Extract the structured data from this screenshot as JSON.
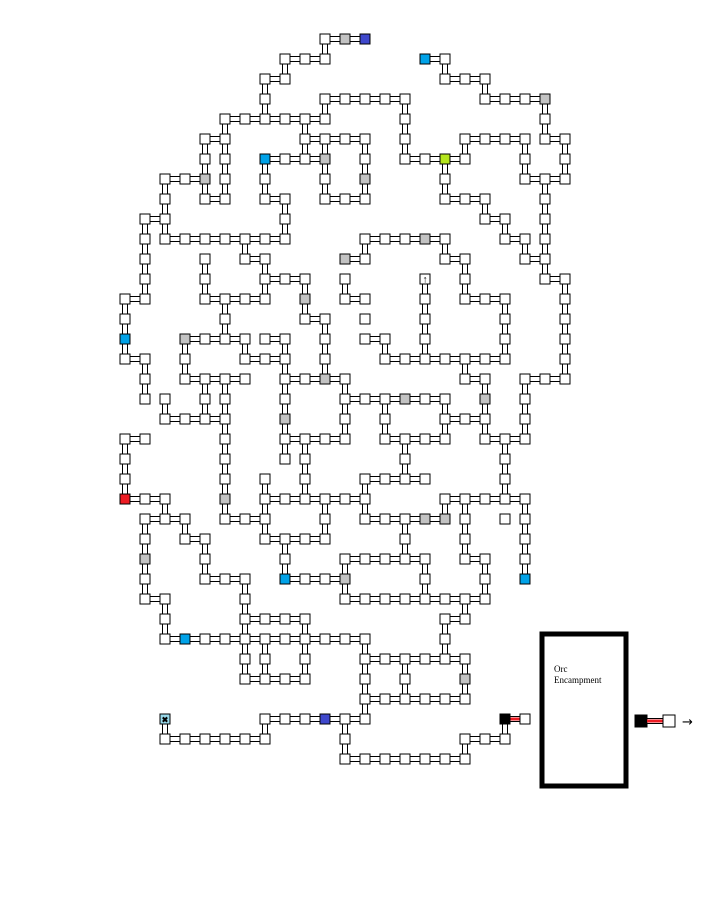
{
  "canvas": {
    "width": 706,
    "height": 902,
    "background": "#ffffff"
  },
  "orc_box": {
    "lines": [
      "Orc",
      "Encampment"
    ]
  },
  "legend": {
    "arrow": "→"
  },
  "map": {
    "grid": {
      "x0": 125,
      "y0": 39,
      "pitch": 20,
      "room_size": 10
    },
    "colors": {
      "w": "#ffffff",
      "g": "#c3c3c3",
      "c": "#00a2e8",
      "b": "#3f48cc",
      "r": "#ed1c24",
      "n": "#b5e61d",
      "k": "#000000",
      "x": "#99d9ea",
      "u": "#ffffff"
    },
    "glyphs": {
      "u": "↑",
      "x": "✖"
    },
    "rooms": [
      "10,0,w",
      "11,0,g",
      "12,0,b",
      "8,1,w",
      "9,1,w",
      "10,1,w",
      "15,1,c",
      "16,1,w",
      "7,2,w",
      "8,2,w",
      "16,2,w",
      "17,2,w",
      "18,2,w",
      "7,3,w",
      "10,3,w",
      "11,3,w",
      "12,3,w",
      "13,3,w",
      "14,3,w",
      "18,3,w",
      "19,3,w",
      "20,3,w",
      "21,3,g",
      "5,4,w",
      "6,4,w",
      "7,4,w",
      "8,4,w",
      "9,4,w",
      "10,4,w",
      "14,4,w",
      "21,4,w",
      "4,5,w",
      "5,5,w",
      "9,5,w",
      "10,5,w",
      "11,5,w",
      "12,5,w",
      "14,5,w",
      "17,5,w",
      "18,5,w",
      "19,5,w",
      "20,5,w",
      "21,5,w",
      "22,5,w",
      "4,6,w",
      "5,6,w",
      "7,6,c",
      "8,6,w",
      "9,6,w",
      "10,6,g",
      "12,6,w",
      "14,6,w",
      "15,6,w",
      "16,6,n",
      "17,6,w",
      "20,6,w",
      "22,6,w",
      "2,7,w",
      "3,7,w",
      "4,7,g",
      "5,7,w",
      "7,7,w",
      "10,7,w",
      "12,7,g",
      "16,7,w",
      "20,7,w",
      "21,7,w",
      "22,7,w",
      "2,8,w",
      "4,8,w",
      "5,8,w",
      "7,8,w",
      "8,8,w",
      "10,8,w",
      "11,8,w",
      "12,8,w",
      "16,8,w",
      "17,8,w",
      "18,8,w",
      "21,8,w",
      "1,9,w",
      "2,9,w",
      "8,9,w",
      "18,9,w",
      "19,9,w",
      "21,9,w",
      "1,10,w",
      "2,10,w",
      "3,10,w",
      "4,10,w",
      "5,10,w",
      "6,10,w",
      "7,10,w",
      "8,10,w",
      "12,10,w",
      "13,10,w",
      "14,10,w",
      "15,10,g",
      "16,10,w",
      "19,10,w",
      "20,10,w",
      "21,10,w",
      "1,11,w",
      "4,11,w",
      "6,11,w",
      "7,11,w",
      "11,11,g",
      "12,11,w",
      "16,11,w",
      "17,11,w",
      "20,11,w",
      "21,11,w",
      "1,12,w",
      "4,12,w",
      "7,12,w",
      "8,12,w",
      "9,12,w",
      "11,12,w",
      "15,12,u",
      "17,12,w",
      "21,12,w",
      "22,12,w",
      "0,13,w",
      "1,13,w",
      "4,13,w",
      "5,13,w",
      "6,13,w",
      "7,13,w",
      "9,13,g",
      "11,13,w",
      "12,13,w",
      "15,13,w",
      "17,13,w",
      "18,13,w",
      "19,13,w",
      "22,13,w",
      "0,14,w",
      "5,14,w",
      "9,14,w",
      "10,14,w",
      "12,14,w",
      "15,14,w",
      "19,14,w",
      "22,14,w",
      "0,15,c",
      "3,15,g",
      "4,15,w",
      "5,15,w",
      "6,15,w",
      "7,15,w",
      "8,15,w",
      "10,15,w",
      "12,15,w",
      "13,15,w",
      "15,15,w",
      "19,15,w",
      "22,15,w",
      "0,16,w",
      "1,16,w",
      "3,16,w",
      "6,16,w",
      "7,16,w",
      "8,16,w",
      "10,16,w",
      "13,16,w",
      "14,16,w",
      "15,16,w",
      "16,16,w",
      "17,16,w",
      "18,16,w",
      "19,16,w",
      "22,16,w",
      "1,17,w",
      "3,17,w",
      "4,17,w",
      "5,17,w",
      "6,17,w",
      "8,17,w",
      "9,17,w",
      "10,17,g",
      "11,17,w",
      "17,17,w",
      "18,17,w",
      "20,17,w",
      "21,17,w",
      "22,17,w",
      "1,18,w",
      "2,18,w",
      "4,18,w",
      "5,18,w",
      "8,18,w",
      "11,18,w",
      "12,18,w",
      "13,18,w",
      "14,18,g",
      "15,18,w",
      "16,18,w",
      "18,18,g",
      "20,18,w",
      "2,19,w",
      "3,19,w",
      "4,19,w",
      "5,19,w",
      "8,19,g",
      "11,19,w",
      "13,19,w",
      "16,19,w",
      "17,19,w",
      "18,19,w",
      "20,19,w",
      "0,20,w",
      "1,20,w",
      "5,20,w",
      "8,20,w",
      "9,20,w",
      "10,20,w",
      "11,20,w",
      "13,20,w",
      "14,20,w",
      "15,20,w",
      "16,20,w",
      "18,20,w",
      "19,20,w",
      "20,20,w",
      "0,21,w",
      "5,21,w",
      "8,21,w",
      "9,21,w",
      "14,21,w",
      "19,21,w",
      "0,22,w",
      "5,22,w",
      "7,22,w",
      "9,22,w",
      "12,22,w",
      "13,22,w",
      "14,22,w",
      "15,22,w",
      "19,22,w",
      "0,23,r",
      "1,23,w",
      "2,23,w",
      "5,23,g",
      "7,23,w",
      "8,23,w",
      "9,23,w",
      "10,23,w",
      "11,23,w",
      "12,23,w",
      "16,23,w",
      "17,23,w",
      "18,23,w",
      "19,23,w",
      "20,23,w",
      "1,24,w",
      "2,24,w",
      "3,24,w",
      "5,24,w",
      "6,24,w",
      "7,24,w",
      "10,24,w",
      "12,24,w",
      "13,24,w",
      "14,24,w",
      "15,24,g",
      "16,24,g",
      "17,24,w",
      "19,24,w",
      "20,24,w",
      "1,25,w",
      "3,25,w",
      "4,25,w",
      "7,25,w",
      "8,25,w",
      "9,25,w",
      "10,25,w",
      "14,25,w",
      "17,25,w",
      "20,25,w",
      "1,26,g",
      "4,26,w",
      "8,26,w",
      "11,26,w",
      "12,26,w",
      "13,26,w",
      "14,26,w",
      "15,26,w",
      "17,26,w",
      "18,26,w",
      "20,26,w",
      "1,27,w",
      "4,27,w",
      "5,27,w",
      "6,27,w",
      "8,27,c",
      "9,27,w",
      "10,27,w",
      "11,27,g",
      "15,27,w",
      "18,27,w",
      "20,27,c",
      "1,28,w",
      "2,28,w",
      "6,28,w",
      "11,28,w",
      "12,28,w",
      "13,28,w",
      "14,28,w",
      "15,28,w",
      "16,28,w",
      "17,28,w",
      "18,28,w",
      "2,29,w",
      "6,29,w",
      "7,29,w",
      "8,29,w",
      "9,29,w",
      "16,29,w",
      "17,29,w",
      "2,30,w",
      "3,30,c",
      "4,30,w",
      "5,30,w",
      "6,30,w",
      "7,30,w",
      "8,30,w",
      "9,30,w",
      "10,30,w",
      "11,30,w",
      "12,30,w",
      "16,30,w",
      "6,31,w",
      "7,31,w",
      "9,31,w",
      "12,31,w",
      "13,31,w",
      "14,31,w",
      "15,31,w",
      "16,31,w",
      "17,31,w",
      "6,32,w",
      "7,32,w",
      "8,32,w",
      "9,32,w",
      "12,32,w",
      "14,32,w",
      "17,32,g",
      "12,33,w",
      "13,33,w",
      "14,33,w",
      "15,33,w",
      "16,33,w",
      "17,33,w",
      "2,34,x",
      "7,34,w",
      "8,34,w",
      "9,34,w",
      "10,34,b",
      "11,34,w",
      "12,34,w",
      "19,34,k",
      "20,34,w",
      "2,35,w",
      "3,35,w",
      "4,35,w",
      "5,35,w",
      "6,35,w",
      "7,35,w",
      "11,35,w",
      "17,35,w",
      "18,35,w",
      "19,35,w",
      "11,36,w",
      "12,36,w",
      "13,36,w",
      "14,36,w",
      "15,36,w",
      "16,36,w",
      "17,36,w"
    ],
    "edges": [
      "10,0|11,0",
      "11,0|12,0",
      "8,1|9,1",
      "9,1|10,1",
      "15,1|16,1",
      "7,2|8,2",
      "16,2|17,2",
      "17,2|18,2",
      "10,3|11,3",
      "11,3|12,3",
      "12,3|13,3",
      "13,3|14,3",
      "18,3|19,3",
      "19,3|20,3",
      "20,3|21,3",
      "5,4|6,4",
      "6,4|7,4",
      "7,4|8,4",
      "8,4|9,4",
      "9,4|10,4",
      "4,5|5,5",
      "9,5|10,5",
      "10,5|11,5",
      "11,5|12,5",
      "17,5|18,5",
      "18,5|19,5",
      "19,5|20,5",
      "21,5|22,5",
      "7,6|8,6",
      "8,6|9,6",
      "9,6|10,6",
      "14,6|15,6",
      "15,6|16,6",
      "16,6|17,6",
      "2,7|3,7",
      "3,7|4,7",
      "20,7|21,7",
      "21,7|22,7",
      "4,8|5,8",
      "7,8|8,8",
      "10,8|11,8",
      "11,8|12,8",
      "16,8|17,8",
      "17,8|18,8",
      "1,9|2,9",
      "18,9|19,9",
      "2,10|3,10",
      "3,10|4,10",
      "4,10|5,10",
      "5,10|6,10",
      "6,10|7,10",
      "7,10|8,10",
      "12,10|13,10",
      "13,10|14,10",
      "14,10|15,10",
      "15,10|16,10",
      "19,10|20,10",
      "6,11|7,11",
      "11,11|12,11",
      "16,11|17,11",
      "20,11|21,11",
      "7,12|8,12",
      "8,12|9,12",
      "21,12|22,12",
      "0,13|1,13",
      "4,13|5,13",
      "5,13|6,13",
      "6,13|7,13",
      "11,13|12,13",
      "17,13|18,13",
      "18,13|19,13",
      "9,14|10,14",
      "3,15|4,15",
      "4,15|5,15",
      "5,15|6,15",
      "7,15|8,15",
      "12,15|13,15",
      "0,16|1,16",
      "6,16|7,16",
      "7,16|8,16",
      "13,16|14,16",
      "14,16|15,16",
      "15,16|16,16",
      "16,16|17,16",
      "17,16|18,16",
      "18,16|19,16",
      "3,17|4,17",
      "4,17|5,17",
      "5,17|6,17",
      "8,17|9,17",
      "9,17|10,17",
      "10,17|11,17",
      "17,17|18,17",
      "20,17|21,17",
      "21,17|22,17",
      "11,18|12,18",
      "12,18|13,18",
      "13,18|14,18",
      "14,18|15,18",
      "15,18|16,18",
      "2,19|3,19",
      "3,19|4,19",
      "4,19|5,19",
      "16,19|17,19",
      "17,19|18,19",
      "0,20|1,20",
      "8,20|9,20",
      "9,20|10,20",
      "10,20|11,20",
      "13,20|14,20",
      "14,20|15,20",
      "15,20|16,20",
      "18,20|19,20",
      "19,20|20,20",
      "12,22|13,22",
      "13,22|14,22",
      "14,22|15,22",
      "0,23|1,23",
      "1,23|2,23",
      "7,23|8,23",
      "8,23|9,23",
      "9,23|10,23",
      "10,23|11,23",
      "11,23|12,23",
      "16,23|17,23",
      "17,23|18,23",
      "18,23|19,23",
      "19,23|20,23",
      "1,24|2,24",
      "2,24|3,24",
      "5,24|6,24",
      "6,24|7,24",
      "12,24|13,24",
      "13,24|14,24",
      "14,24|15,24",
      "15,24|16,24",
      "3,25|4,25",
      "7,25|8,25",
      "8,25|9,25",
      "9,25|10,25",
      "11,26|12,26",
      "12,26|13,26",
      "13,26|14,26",
      "14,26|15,26",
      "17,26|18,26",
      "4,27|5,27",
      "5,27|6,27",
      "8,27|9,27",
      "9,27|10,27",
      "10,27|11,27",
      "1,28|2,28",
      "11,28|12,28",
      "12,28|13,28",
      "13,28|14,28",
      "14,28|15,28",
      "15,28|16,28",
      "16,28|17,28",
      "17,28|18,28",
      "6,29|7,29",
      "7,29|8,29",
      "8,29|9,29",
      "16,29|17,29",
      "2,30|3,30",
      "3,30|4,30",
      "4,30|5,30",
      "5,30|6,30",
      "6,30|7,30",
      "7,30|8,30",
      "8,30|9,30",
      "9,30|10,30",
      "10,30|11,30",
      "11,30|12,30",
      "12,31|13,31",
      "13,31|14,31",
      "14,31|15,31",
      "15,31|16,31",
      "16,31|17,31",
      "6,32|7,32",
      "7,32|8,32",
      "8,32|9,32",
      "12,33|13,33",
      "13,33|14,33",
      "14,33|15,33",
      "15,33|16,33",
      "16,33|17,33",
      "7,34|8,34",
      "8,34|9,34",
      "9,34|10,34",
      "10,34|11,34",
      "11,34|12,34",
      "2,35|3,35",
      "3,35|4,35",
      "4,35|5,35",
      "5,35|6,35",
      "6,35|7,35",
      "17,35|18,35",
      "18,35|19,35",
      "11,36|12,36",
      "12,36|13,36",
      "13,36|14,36",
      "14,36|15,36",
      "15,36|16,36",
      "16,36|17,36",
      "0,13|0,14",
      "0,14|0,15",
      "0,15|0,16",
      "0,20|0,21",
      "0,21|0,22",
      "0,22|0,23",
      "1,9|1,10",
      "1,10|1,11",
      "1,11|1,12",
      "1,12|1,13",
      "1,16|1,17",
      "1,17|1,18",
      "1,24|1,25",
      "1,25|1,26",
      "1,26|1,27",
      "1,27|1,28",
      "2,7|2,8",
      "2,8|2,9",
      "2,9|2,10",
      "2,18|2,19",
      "2,23|2,24",
      "2,28|2,29",
      "2,29|2,30",
      "2,34|2,35",
      "3,15|3,16",
      "3,16|3,17",
      "3,24|3,25",
      "4,5|4,6",
      "4,6|4,7",
      "4,7|4,8",
      "4,11|4,12",
      "4,12|4,13",
      "4,17|4,18",
      "4,18|4,19",
      "4,25|4,26",
      "4,26|4,27",
      "5,4|5,5",
      "5,5|5,6",
      "5,6|5,7",
      "5,7|5,8",
      "5,13|5,14",
      "5,14|5,15",
      "5,17|5,18",
      "5,18|5,19",
      "5,19|5,20",
      "5,20|5,21",
      "5,21|5,22",
      "5,22|5,23",
      "5,23|5,24",
      "6,10|6,11",
      "6,15|6,16",
      "6,27|6,28",
      "6,28|6,29",
      "6,29|6,30",
      "6,30|6,31",
      "6,31|6,32",
      "7,2|7,3",
      "7,3|7,4",
      "7,6|7,7",
      "7,7|7,8",
      "7,11|7,12",
      "7,12|7,13",
      "7,22|7,23",
      "7,23|7,24",
      "7,24|7,25",
      "7,30|7,31",
      "7,31|7,32",
      "7,34|7,35",
      "8,1|8,2",
      "8,8|8,9",
      "8,9|8,10",
      "8,15|8,16",
      "8,16|8,17",
      "8,17|8,18",
      "8,18|8,19",
      "8,19|8,20",
      "8,20|8,21",
      "8,25|8,26",
      "8,26|8,27",
      "9,4|9,5",
      "9,5|9,6",
      "9,12|9,13",
      "9,13|9,14",
      "9,20|9,21",
      "9,21|9,22",
      "9,22|9,23",
      "9,29|9,30",
      "9,30|9,31",
      "9,31|9,32",
      "10,0|10,1",
      "10,3|10,4",
      "10,5|10,6",
      "10,6|10,7",
      "10,7|10,8",
      "10,14|10,15",
      "10,15|10,16",
      "10,16|10,17",
      "10,23|10,24",
      "10,24|10,25",
      "11,12|11,13",
      "11,17|11,18",
      "11,18|11,19",
      "11,19|11,20",
      "11,26|11,27",
      "11,27|11,28",
      "11,34|11,35",
      "11,35|11,36",
      "12,5|12,6",
      "12,6|12,7",
      "12,7|12,8",
      "12,10|12,11",
      "12,22|12,23",
      "12,23|12,24",
      "12,30|12,31",
      "12,31|12,32",
      "12,32|12,33",
      "12,33|12,34",
      "13,15|13,16",
      "13,18|13,19",
      "13,19|13,20",
      "14,3|14,4",
      "14,4|14,5",
      "14,5|14,6",
      "14,20|14,21",
      "14,21|14,22",
      "14,24|14,25",
      "14,25|14,26",
      "14,31|14,32",
      "14,32|14,33",
      "15,12|15,13",
      "15,13|15,14",
      "15,14|15,15",
      "15,15|15,16",
      "15,26|15,27",
      "15,27|15,28",
      "16,1|16,2",
      "16,6|16,7",
      "16,7|16,8",
      "16,10|16,11",
      "16,18|16,19",
      "16,19|16,20",
      "16,23|16,24",
      "16,29|16,30",
      "16,30|16,31",
      "17,5|17,6",
      "17,11|17,12",
      "17,12|17,13",
      "17,16|17,17",
      "17,23|17,24",
      "17,24|17,25",
      "17,25|17,26",
      "17,28|17,29",
      "17,31|17,32",
      "17,32|17,33",
      "17,35|17,36",
      "18,2|18,3",
      "18,8|18,9",
      "18,17|18,18",
      "18,18|18,19",
      "18,19|18,20",
      "18,26|18,27",
      "18,27|18,28",
      "19,9|19,10",
      "19,13|19,14",
      "19,14|19,15",
      "19,15|19,16",
      "19,20|19,21",
      "19,21|19,22",
      "19,22|19,23",
      "19,34|19,35",
      "20,5|20,6",
      "20,6|20,7",
      "20,10|20,11",
      "20,17|20,18",
      "20,18|20,19",
      "20,19|20,20",
      "20,23|20,24",
      "20,24|20,25",
      "20,25|20,26",
      "20,26|20,27",
      "21,3|21,4",
      "21,4|21,5",
      "21,7|21,8",
      "21,8|21,9",
      "21,9|21,10",
      "21,10|21,11",
      "21,11|21,12",
      "22,5|22,6",
      "22,6|22,7",
      "22,12|22,13",
      "22,13|22,14",
      "22,14|22,15",
      "22,15|22,16",
      "22,16|22,17"
    ],
    "red_edges": [
      "19,34|20,34"
    ]
  }
}
